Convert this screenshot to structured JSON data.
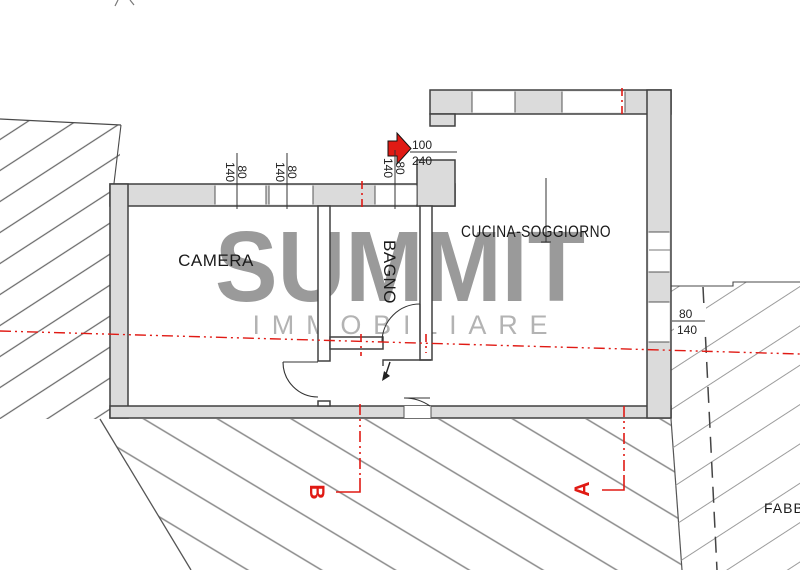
{
  "watermark": {
    "title": "SUMMIT",
    "subtitle": "IMMOBILIARE"
  },
  "rooms": {
    "camera": "CAMERA",
    "bagno": "BAGNO",
    "cucina_soggiorno": "CUCINA-SOGGIORNO"
  },
  "section_labels": {
    "a": "A",
    "b": "B"
  },
  "adjacent_building_label": "FABBRI",
  "dimensions": {
    "camera_window_1": {
      "width": "80",
      "height": "140"
    },
    "camera_window_2": {
      "width": "80",
      "height": "140"
    },
    "bagno_window": {
      "width": "80",
      "height": "140"
    },
    "entrance_door": {
      "width": "100",
      "height": "240"
    },
    "right_window": {
      "width": "80",
      "height": "140"
    }
  },
  "colors": {
    "accent_red": "#e01a14",
    "wall_fill": "#dbdbdb",
    "watermark_gray": "#9a9a9a",
    "hatch_gray": "#8a8a8a"
  }
}
